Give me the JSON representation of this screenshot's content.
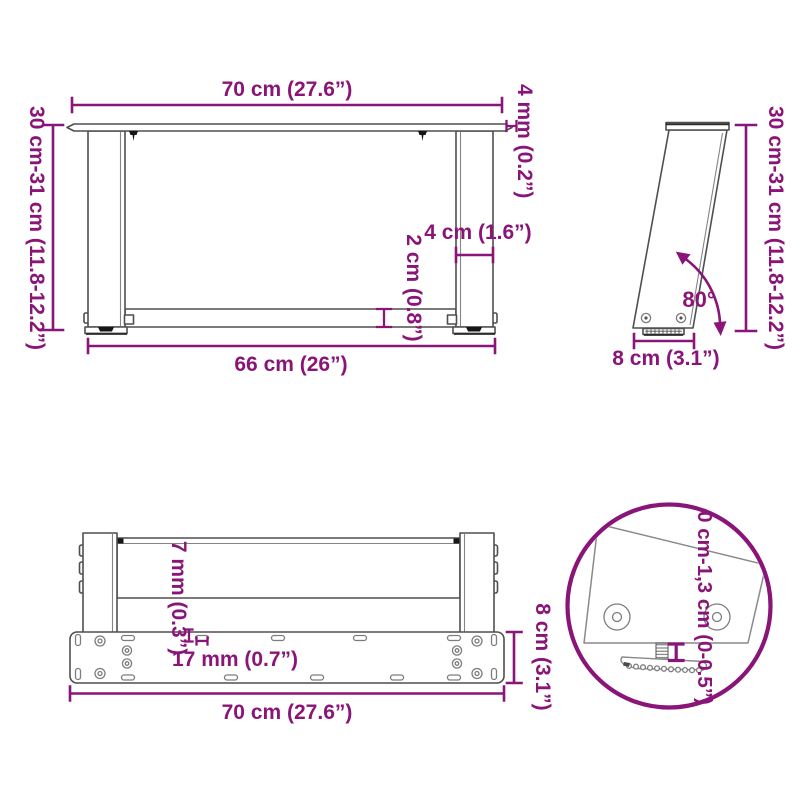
{
  "colors": {
    "accent": "#8A1578",
    "line": "#4F4F4F"
  },
  "front_view": {
    "width_top": "70 cm (27.6”)",
    "top_thickness": "4 mm (0.2”)",
    "height_range": "30 cm-31 cm (11.8-12.2”)",
    "leg_width": "4 cm (1.6”)",
    "stretcher_thickness": "2 cm (0.8”)",
    "width_inner": "66 cm (26”)"
  },
  "side_view": {
    "height_range": "30 cm-31 cm (11.8-12.2”)",
    "tilt_angle": "80°",
    "base_depth": "8 cm (3.1”)"
  },
  "bottom_view": {
    "plate_thickness": "7 mm (0.3”)",
    "hole_spacing": "17 mm (0.7”)",
    "width_total": "70 cm (27.6”)",
    "plate_depth": "8 cm (3.1”)"
  },
  "detail_view": {
    "height_adjustment": "0 cm-1,3 cm (0-0.5”)"
  }
}
